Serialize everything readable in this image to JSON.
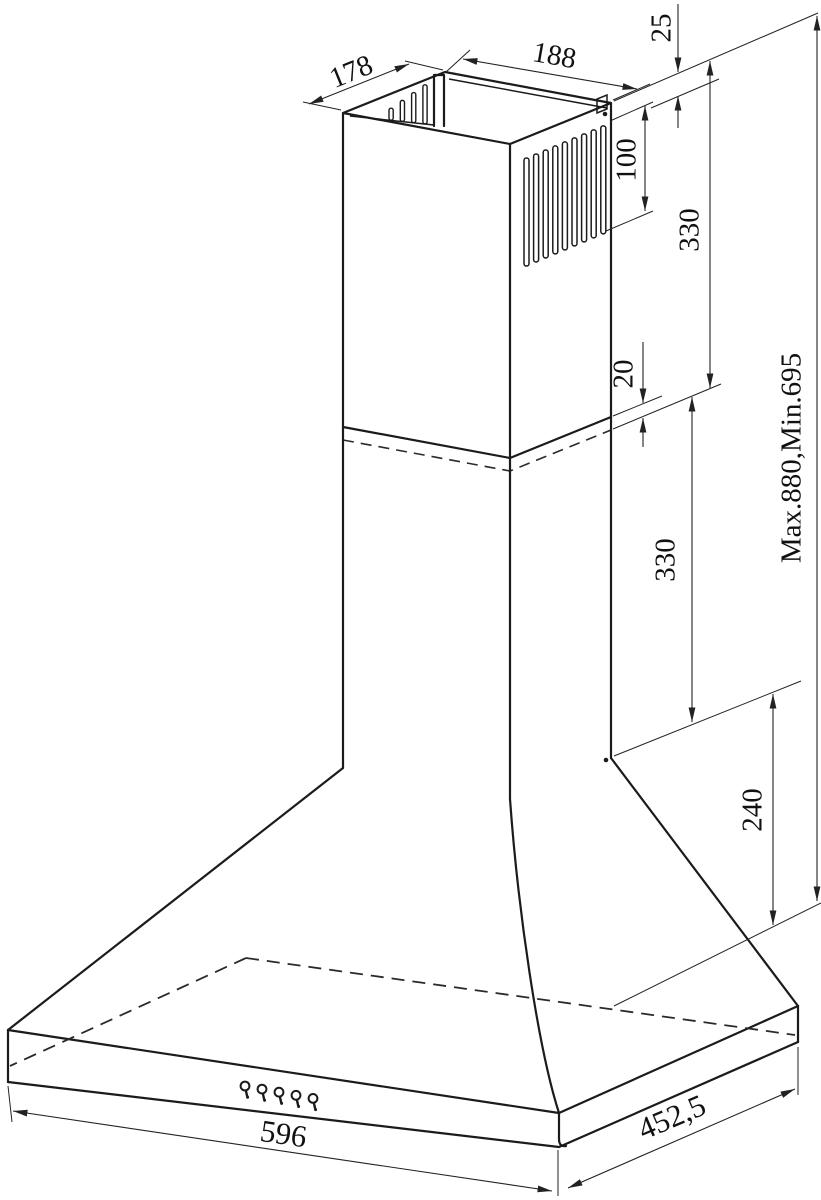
{
  "diagram": {
    "type": "technical-drawing",
    "subject": "Chimney cooker hood with telescopic flue - dimensioned isometric view",
    "units": "mm",
    "colors": {
      "background": "#ffffff",
      "object_line": "#1b1b1b",
      "dimension_line": "#222222"
    },
    "dimensions": {
      "flue_depth": "178",
      "flue_width": "188",
      "ceiling_gap": "25",
      "vent_height": "100",
      "upper_flue_height": "330",
      "overlap": "20",
      "lower_flue_height": "330",
      "total_height_range": "Max.880,Min.695",
      "canopy_height": "240",
      "hood_width": "596",
      "hood_depth": "452,5"
    },
    "features": {
      "louver_slots": 9,
      "inner_slots": 4,
      "control_buttons": 5,
      "screws": 2
    }
  }
}
